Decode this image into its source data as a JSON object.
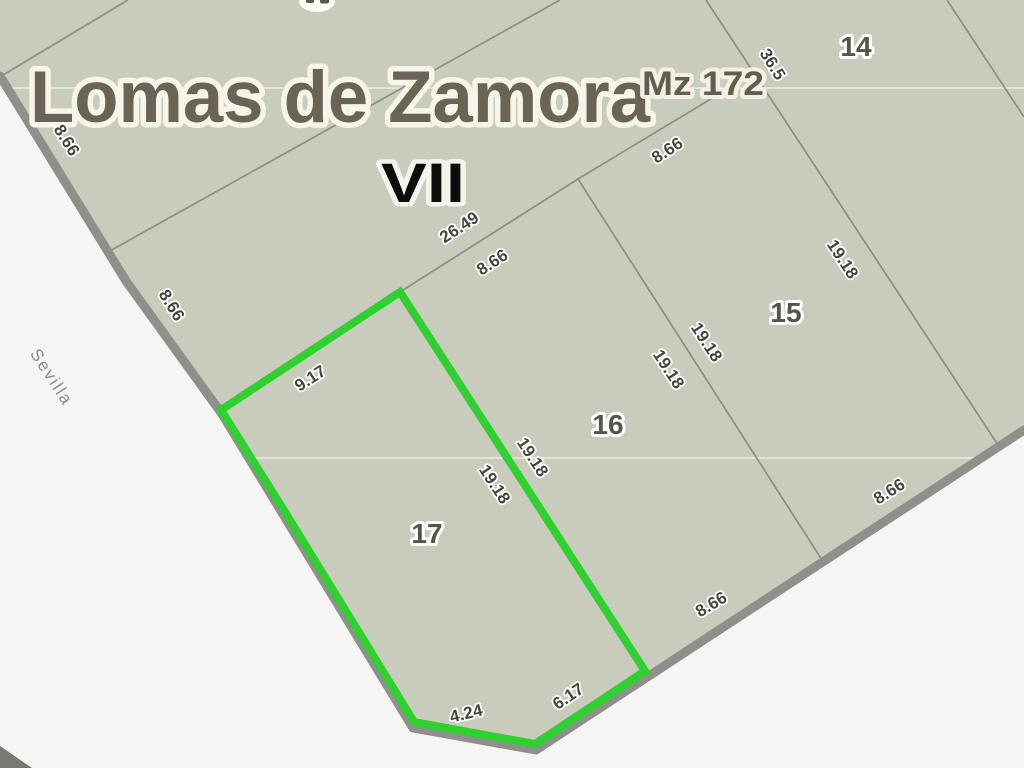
{
  "map": {
    "title": "Lomas de Zamora",
    "block_label": "Mz 172",
    "section_label": "VII",
    "street_name": "Sevilla",
    "parcels": {
      "p14": "14",
      "p15": "15",
      "p16": "16",
      "p17": "17"
    },
    "dimensions": {
      "front_nw": "8.66",
      "front_w": "8.66",
      "lot17_back": "9.17",
      "back_total": "26.49",
      "lot16_back": "8.66",
      "lot15_back": "8.66",
      "lot14_side": "36.5",
      "lot17_side": "19.18",
      "lot16_side_w": "19.18",
      "lot16_side_e": "19.18",
      "lot15_side_w": "19.18",
      "lot15_side_e": "19.18",
      "lot17_front_sw": "4.24",
      "lot17_front_se": "6.17",
      "lot16_front": "8.66",
      "lot15_front": "8.66"
    }
  },
  "colors": {
    "parcel_fill": "#c9ccbd",
    "street_fill": "#f5f6f4",
    "street_edge": "#8e908b",
    "lot_line": "#8b8e85",
    "faint_line": "#e9ece1",
    "highlight_green": "#2fd030",
    "corner_shape": "#787a72",
    "fragment_halo": "#fdfcf6",
    "fragment_glyph": "#5a564c"
  }
}
